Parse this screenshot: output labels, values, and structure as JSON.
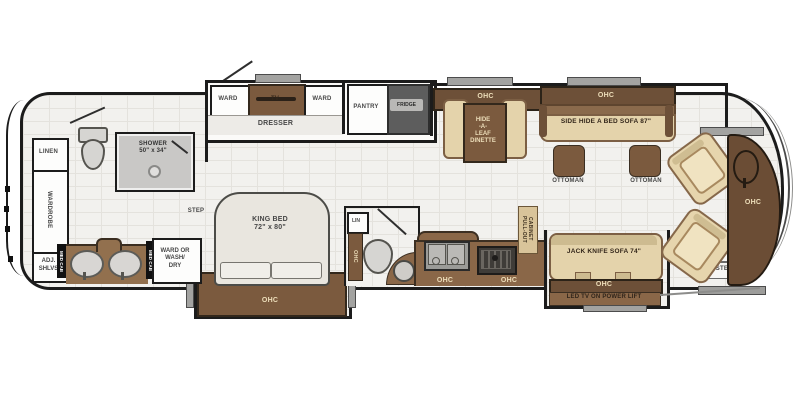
{
  "plan": {
    "type": "rv-motorhome-floorplan",
    "colors": {
      "wall": "#1c1c1c",
      "floor_tile": "#f2f1ee",
      "cabinet_dark_brown": "#6d5038",
      "counter_brown": "#8a6748",
      "upholstery_tan": "#e4d3ab",
      "label_cream": "#eddeba",
      "appliance_gray": "#5d5d5d",
      "fixture_gray": "#d6d5d2"
    },
    "rear_bath": {
      "linen": "LINEN",
      "wardrobe": "WARDROBE",
      "adj_shelves": "ADJ.\nSHLVS",
      "shower": "SHOWER\n50\" x 34\"",
      "med_cab_left": "MED CAB",
      "med_cab_right": "MED CAB",
      "ward_or_washdry": "WARD OR\nWASH/\nDRY",
      "step": "STEP"
    },
    "bedroom": {
      "ward_left": "WARD",
      "tv": "TV",
      "ward_right": "WARD",
      "dresser": "DRESSER",
      "king_bed": "KING BED\n72\" x 80\"",
      "ohc": "OHC"
    },
    "kitchen": {
      "pantry": "PANTRY",
      "fridge": "FRIDGE",
      "pull_out_cabinet": "PULL-OUT\nCABINET",
      "ohc_left": "OHC",
      "ohc_right": "OHC"
    },
    "dinette": {
      "ohc": "OHC",
      "table": "HIDE\n-A-\nLEAF\nDINETTE"
    },
    "living": {
      "sofa_ohc": "OHC",
      "side_sofa": "SIDE HIDE A BED SOFA 87\"",
      "ottoman_left": "OTTOMAN",
      "ottoman_right": "OTTOMAN",
      "jack_knife_sofa": "JACK KNIFE SOFA 74\"",
      "jack_ohc": "OHC",
      "led_tv": "LED TV ON POWER LIFT"
    },
    "half_bath": {
      "linen": "LIN",
      "ohc": "OHC"
    },
    "cab": {
      "ohc": "OHC",
      "step_upper": "STEP",
      "step_lower": "STEP"
    }
  }
}
